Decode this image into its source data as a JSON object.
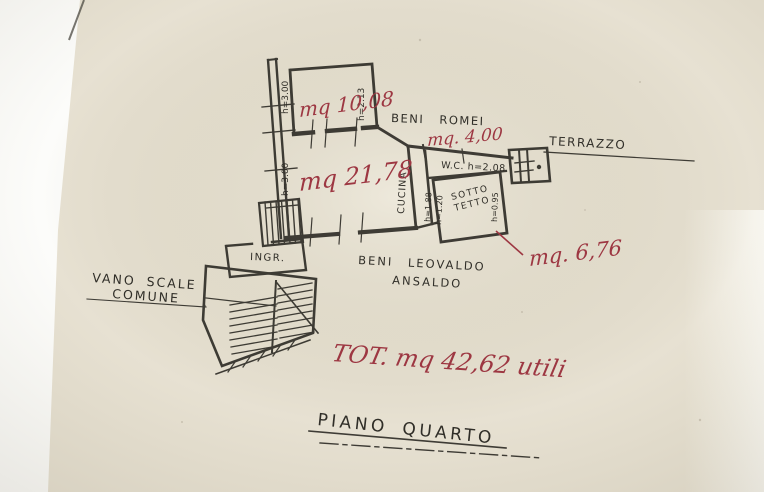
{
  "photo": {
    "paper_color": "#e7e1d2",
    "ink_color": "#302e28",
    "red_ink_color": "#9d3742"
  },
  "plan": {
    "floor_title": "PIANO QUARTO",
    "total_note": "TOT. mq 42,62 utili",
    "owner_romei": {
      "name": "BENI ROMEI",
      "area": "mq. 4,00"
    },
    "owner_ansaldo": {
      "name_line1": "BENI LEOVALDO",
      "name_line2": "ANSALDO",
      "area": "mq. 6,76"
    },
    "stairwell": {
      "label_line1": "VANO SCALE",
      "label_line2": "COMUNE"
    },
    "rooms": {
      "top_room": {
        "area": "mq 10,08",
        "height_left": "h=3.00",
        "height_right": "h=2.13"
      },
      "main_room": {
        "area": "mq 21,78",
        "height_left": "h=3.00"
      },
      "kitchen": {
        "label": "CUCINA"
      },
      "wc": {
        "label": "W.C. h=2.08"
      },
      "attic": {
        "label_line1": "SOTTO",
        "label_line2": "TETTO",
        "height_a": "h=1.88",
        "height_b": "h=1.20",
        "height_c": "h=0.95"
      },
      "terrace": {
        "label": "TERRAZZO"
      },
      "entrance": {
        "label": "INGR."
      }
    }
  }
}
